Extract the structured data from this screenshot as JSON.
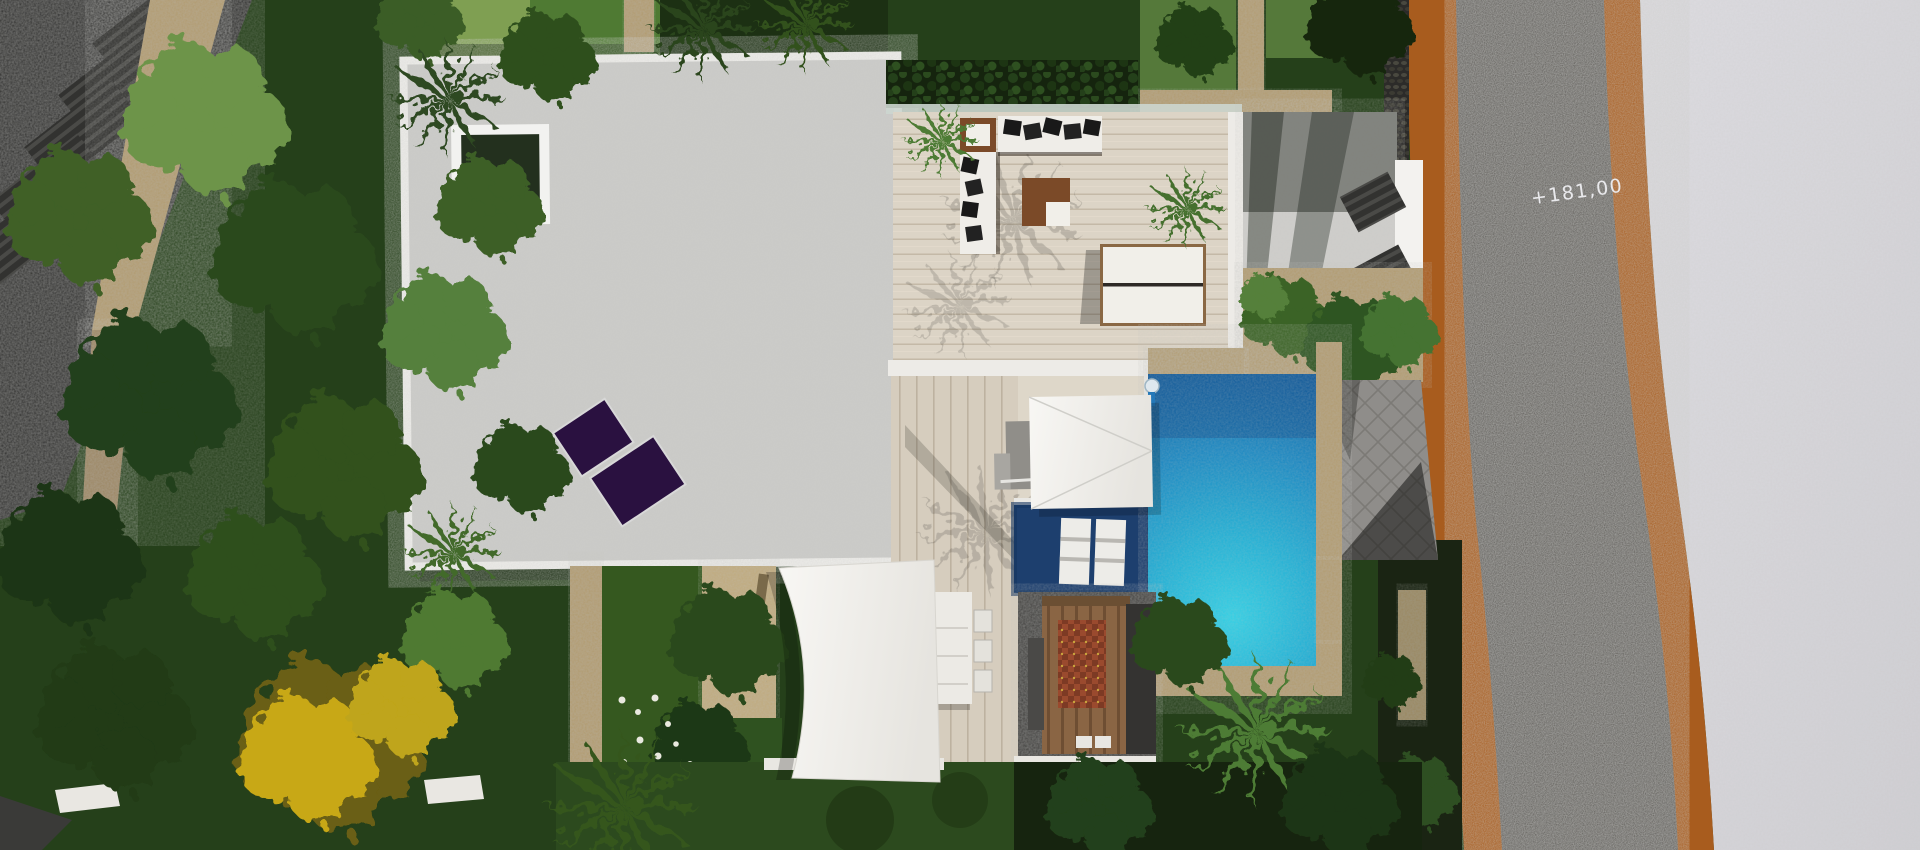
{
  "scene": {
    "type": "aerial-architectural-render",
    "title": "Top-down 3D render of a modern villa plot with pool and garden",
    "elevation_label": "+181,00",
    "colors": {
      "road_asphalt": "#57544f",
      "road_curb": "#a85c1e",
      "sidewalk": "#d8d7db",
      "roof": "#c9c9c6",
      "roof_border": "#f0efec",
      "deck": "#d9cfc0",
      "pool_main": "#1787c2",
      "pool_deep": "#1d3f6e",
      "solar_panel": "#2a1140",
      "lawn": "#2c4a1e",
      "stone": "#b19b6e",
      "hedge": "#16260f",
      "canopy_yellow": "#c0a41a",
      "kitchen_wood": "#8a6544",
      "rug": "#9a4a2e"
    },
    "objects": {
      "roof": "villa flat roof with skylight and solar panels",
      "terrace": "roof terrace with L-shaped sofa, coffee table and double sunbed",
      "pool": "L-shaped swimming pool with submerged loungers",
      "canopy": "square white shade canopy at pool edge",
      "sail": "white shade sail over lawn",
      "dining": "outdoor dining table with chairs on wood deck",
      "kitchen": "covered outdoor kitchen with rug and counters",
      "driveway": "herringbone paver driveway",
      "road": "asphalt road with corten edging",
      "garden": "dense garden with palms, green and yellow trees"
    }
  }
}
